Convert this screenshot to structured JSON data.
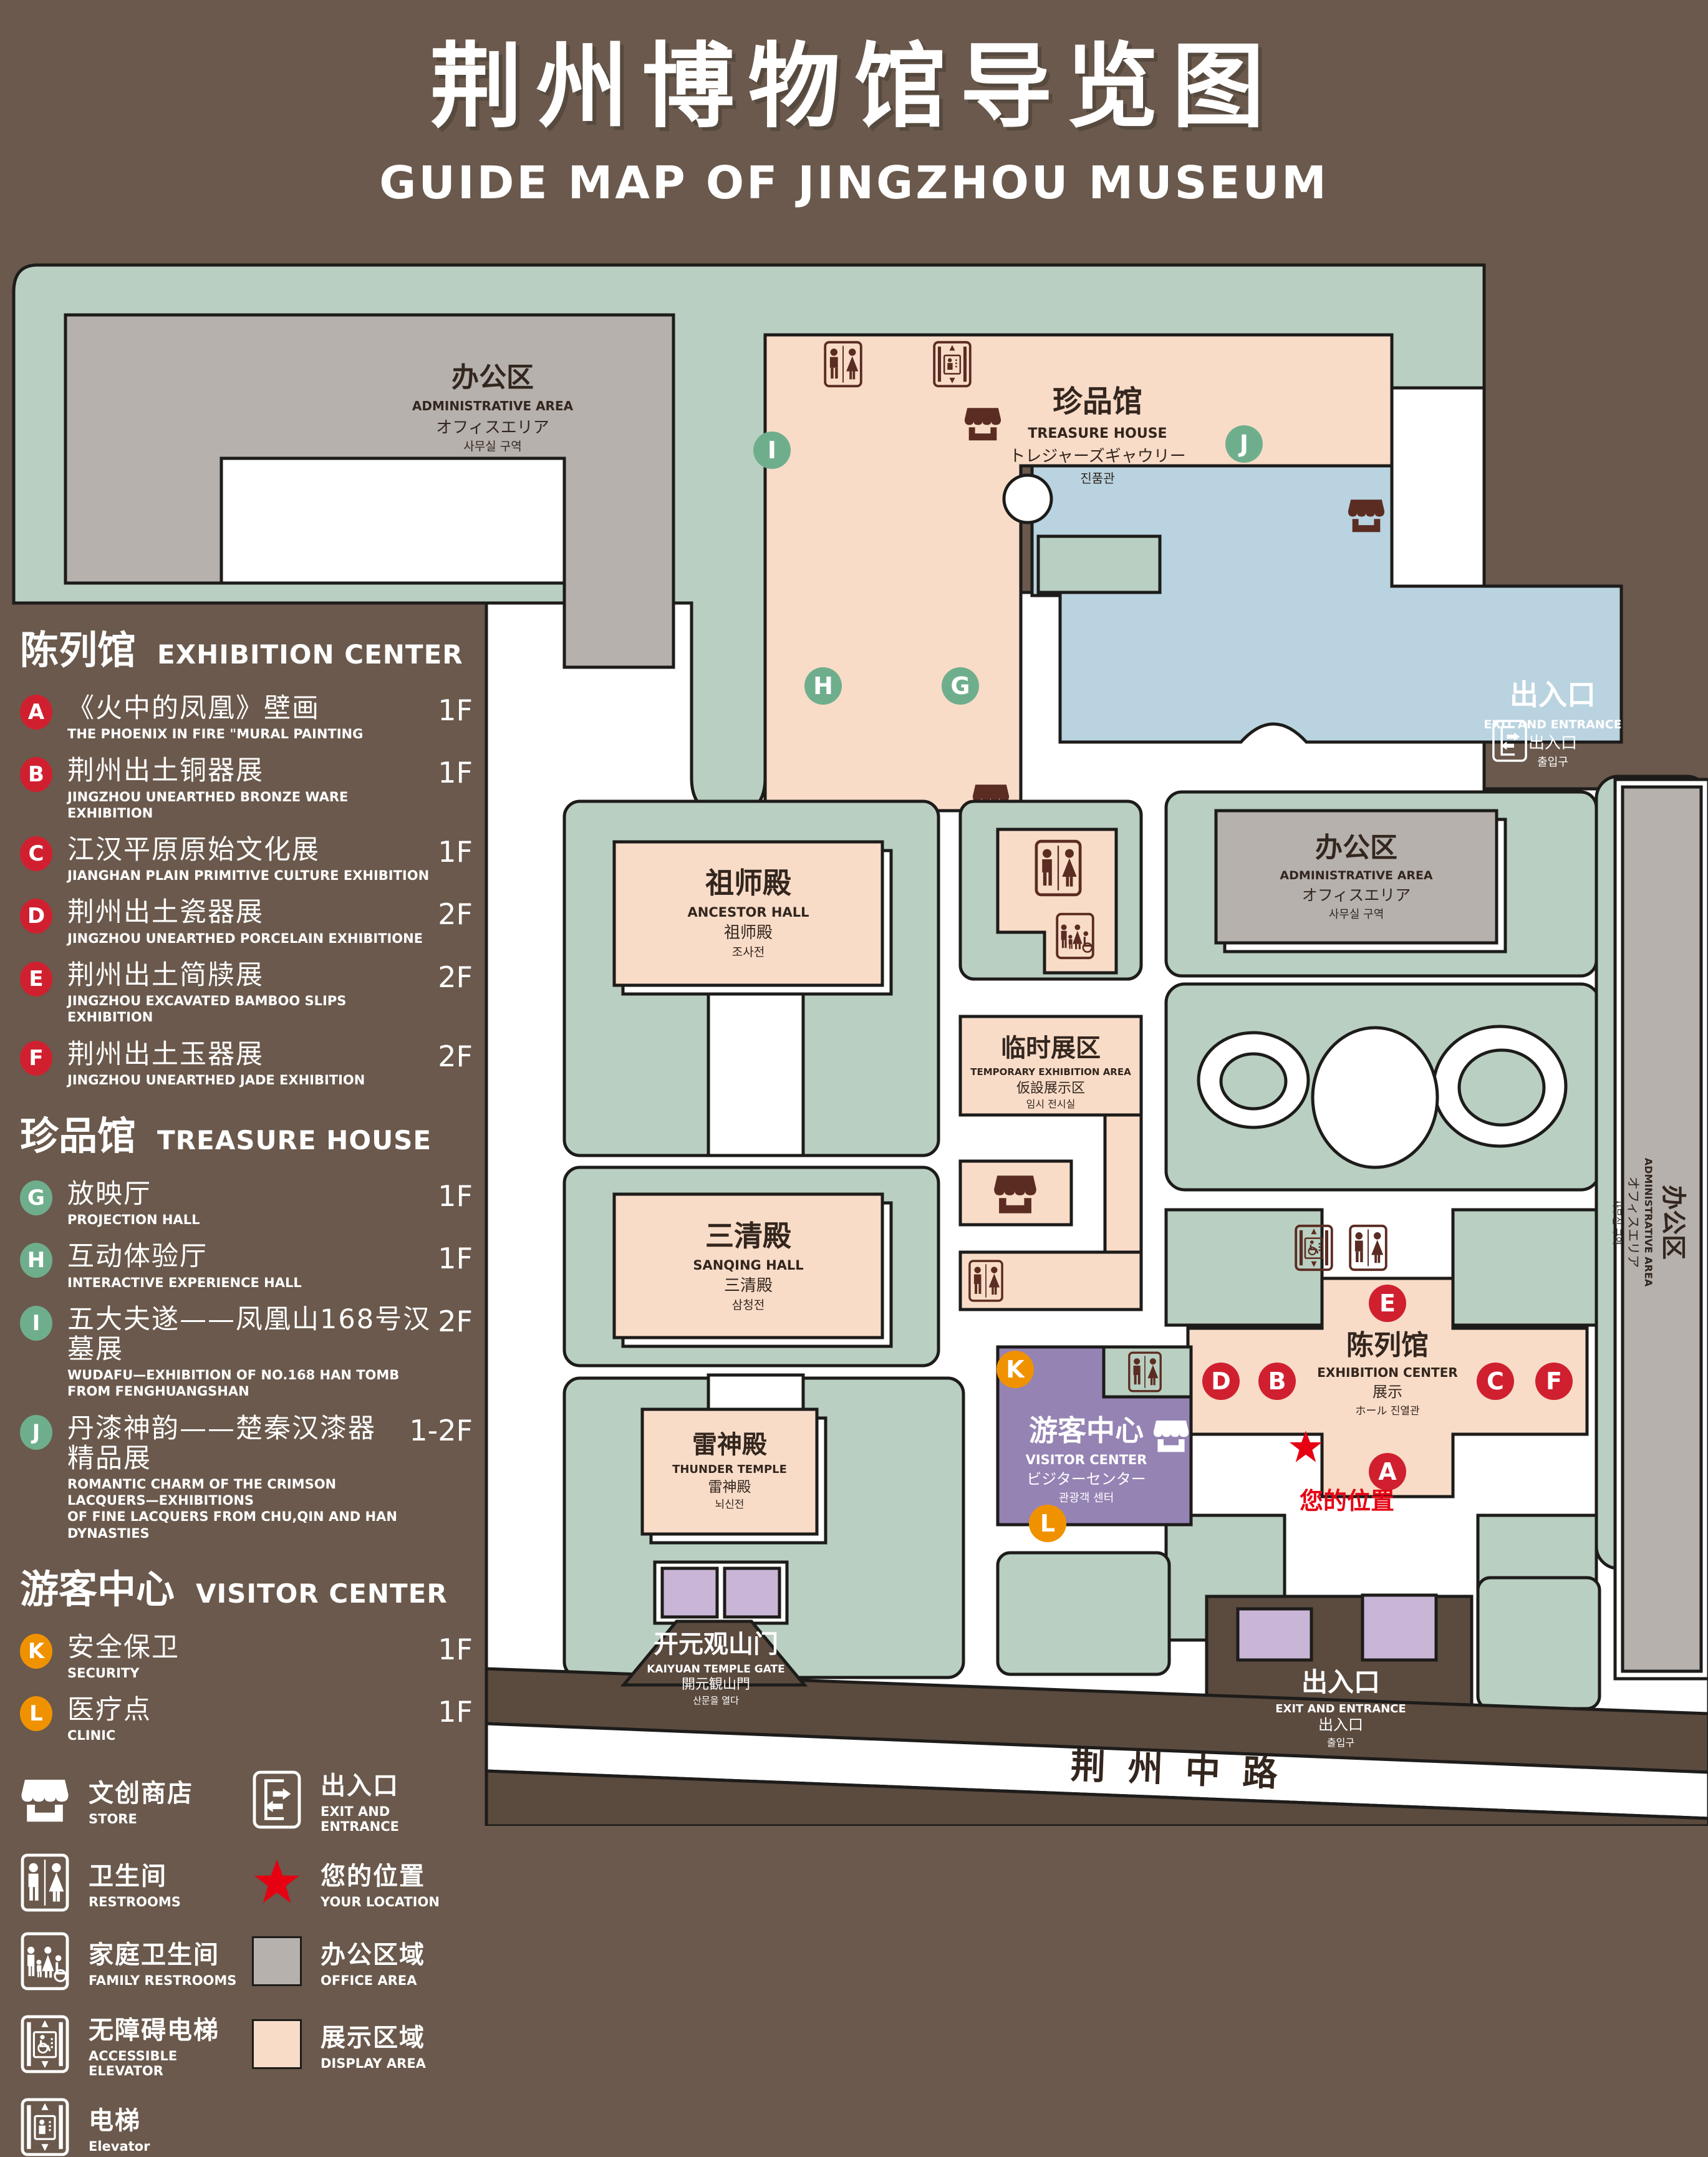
{
  "header": {
    "title_cn": "荆州博物馆导览图",
    "title_en": "GUIDE MAP OF JINGZHOU MUSEUM"
  },
  "legend": {
    "exhibition": {
      "title_cn": "陈列馆",
      "title_en": "EXHIBITION CENTER",
      "items": [
        {
          "code": "A",
          "cn": "《火中的凤凰》壁画",
          "en": "THE PHOENIX IN FIRE \"MURAL PAINTING",
          "floor": "1F"
        },
        {
          "code": "B",
          "cn": "荆州出土铜器展",
          "en": "JINGZHOU UNEARTHED BRONZE WARE EXHIBITION",
          "floor": "1F"
        },
        {
          "code": "C",
          "cn": "江汉平原原始文化展",
          "en": "JIANGHAN PLAIN PRIMITIVE CULTURE EXHIBITION",
          "floor": "1F"
        },
        {
          "code": "D",
          "cn": "荆州出土瓷器展",
          "en": "JINGZHOU UNEARTHED PORCELAIN EXHIBITIONE",
          "floor": "2F"
        },
        {
          "code": "E",
          "cn": "荆州出土简牍展",
          "en": "JINGZHOU EXCAVATED BAMBOO SLIPS EXHIBITION",
          "floor": "2F"
        },
        {
          "code": "F",
          "cn": "荆州出土玉器展",
          "en": "JINGZHOU UNEARTHED JADE EXHIBITION",
          "floor": "2F"
        }
      ]
    },
    "treasure": {
      "title_cn": "珍品馆",
      "title_en": "TREASURE HOUSE",
      "items": [
        {
          "code": "G",
          "cn": "放映厅",
          "en": "PROJECTION HALL",
          "floor": "1F"
        },
        {
          "code": "H",
          "cn": "互动体验厅",
          "en": "INTERACTIVE EXPERIENCE HALL",
          "floor": "1F"
        },
        {
          "code": "I",
          "cn": "五大夫遂——凤凰山168号汉墓展",
          "en": "WUDAFU—EXHIBITION OF NO.168 HAN TOMB FROM FENGHUANGSHAN",
          "floor": "2F"
        },
        {
          "code": "J",
          "cn": "丹漆神韵——楚秦汉漆器精品展",
          "en": "ROMANTIC CHARM OF THE CRIMSON LACQUERS—EXHIBITIONS",
          "en2": "OF FINE LACQUERS FROM CHU,QIN AND HAN DYNASTIES",
          "floor": "1-2F"
        }
      ]
    },
    "visitor": {
      "title_cn": "游客中心",
      "title_en": "VISITOR CENTER",
      "items": [
        {
          "code": "K",
          "cn": "安全保卫",
          "en": "SECURITY",
          "floor": "1F"
        },
        {
          "code": "L",
          "cn": "医疗点",
          "en": "CLINIC",
          "floor": "1F"
        }
      ]
    },
    "symbols": {
      "store": {
        "cn": "文创商店",
        "en": "STORE"
      },
      "exit": {
        "cn": "出入口",
        "en": "EXIT AND ENTRANCE"
      },
      "restrooms": {
        "cn": "卫生间",
        "en": "RESTROOMS"
      },
      "location": {
        "cn": "您的位置",
        "en": "YOUR LOCATION"
      },
      "family": {
        "cn": "家庭卫生间",
        "en": "FAMILY RESTROOMS"
      },
      "office": {
        "cn": "办公区域",
        "en": "OFFICE AREA"
      },
      "accessible": {
        "cn": "无障碍电梯",
        "en": "ACCESSIBLE ELEVATOR"
      },
      "display": {
        "cn": "展示区域",
        "en": "DISPLAY AREA"
      },
      "elevator": {
        "cn": "电梯",
        "en": "Elevator"
      }
    }
  },
  "map": {
    "admin_tl": {
      "cn": "办公区",
      "en": "ADMINISTRATIVE AREA",
      "jp": "オフィスエリア",
      "kr": "사무실 구역"
    },
    "treasure_house": {
      "cn": "珍品馆",
      "en": "TREASURE HOUSE",
      "jp": "トレジャーズギャウリー",
      "kr": "진품관"
    },
    "ancestor_hall": {
      "cn": "祖师殿",
      "en": "ANCESTOR HALL",
      "jp": "祖师殿",
      "kr": "조사전"
    },
    "sanqing_hall": {
      "cn": "三清殿",
      "en": "SANQING HALL",
      "jp": "三清殿",
      "kr": "삼청전"
    },
    "thunder_temple": {
      "cn": "雷神殿",
      "en": "THUNDER TEMPLE",
      "jp": "雷神殿",
      "kr": "뇌신전"
    },
    "temporary": {
      "cn": "临时展区",
      "en": "TEMPORARY EXHIBITION AREA",
      "jp": "仮設展示区",
      "kr": "임시 전시실"
    },
    "admin_right": {
      "cn": "办公区",
      "en": "ADMINISTRATIVE AREA",
      "jp": "オフィスエリア",
      "kr": "사무실 구역"
    },
    "admin_strip": {
      "cn": "办公区",
      "en": "ADMINISTRATIVE AREA",
      "jp": "オフィスエリア",
      "kr": "사무실 구역"
    },
    "exhibition_center": {
      "cn": "陈列馆",
      "en": "EXHIBITION CENTER",
      "jp": "展示",
      "kr": "ホール 진열관"
    },
    "visitor_center": {
      "cn": "游客中心",
      "en": "VISITOR CENTER",
      "jp": "ビジターセンター",
      "kr": "관광객 센터"
    },
    "gate": {
      "cn": "开元观山门",
      "en": "KAIYUAN TEMPLE GATE",
      "jp": "開元観山門",
      "kr": "산문을 열다"
    },
    "exit_tr": {
      "cn": "出入口",
      "en": "EXIT AND ENTRANCE",
      "jp": "出入口",
      "kr": "출입구"
    },
    "exit_br": {
      "cn": "出入口",
      "en": "EXIT AND ENTRANCE",
      "jp": "出入口",
      "kr": "출입구"
    },
    "road": "荆州中路"
  },
  "colors": {
    "bg": "#6A594C",
    "line": "#1D1C1A",
    "lawn": "#B9CFC1",
    "display": "#F8DCC8",
    "office": "#B6B1AC",
    "water": "#B9D3E0",
    "visitor": "#9583B4",
    "purplelite": "#C9B5D6",
    "road": "#5B4A3E",
    "icon": "#5B2C22",
    "ink": "#33261E",
    "mred": "#D02030",
    "mgreen": "#6FAE8D",
    "morange": "#F09200",
    "locred": "#E60012"
  }
}
